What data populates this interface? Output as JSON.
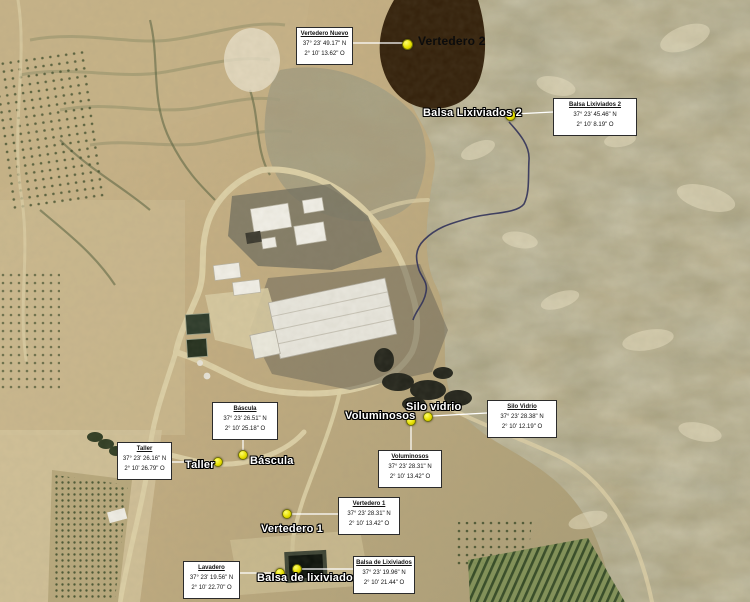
{
  "map": {
    "kind": "annotated-satellite-map",
    "subject": "waste treatment facility and landfill site"
  },
  "colors": {
    "terrain_tan": "#c3ad81",
    "badlands_olive": "#a89c76",
    "marker_yellow": "#e8e000",
    "marker_border": "#6f6f05",
    "vertedero2_fill": "#33200a",
    "callout_bg": "#ffffff",
    "callout_border": "#2b2b2b",
    "label_white": "#ffffff",
    "label_dark": "#0c0c0c",
    "leader_line": "#ffffff",
    "stream_line": "#2b2c58",
    "orchard_green": "#2f4722",
    "pond_dark": "#0c120b"
  },
  "labels": [
    {
      "text": "Vertedero 2"
    },
    {
      "text": "Balsa Lixiviados 2"
    },
    {
      "text": "Voluminosos"
    },
    {
      "text": "Silo vidrio"
    },
    {
      "text": "Taller"
    },
    {
      "text": "Báscula"
    },
    {
      "text": "Vertedero 1"
    },
    {
      "text": "Balsa de lixiviados"
    }
  ],
  "callouts": [
    {
      "title": "Vertedero Nuevo",
      "lat": "37° 23' 49.17\" N",
      "lon": "2° 10' 13.62\" O"
    },
    {
      "title": "Balsa Lixiviados 2",
      "lat": "37° 23' 45.46\" N",
      "lon": "2° 10' 8.19\" O"
    },
    {
      "title": "Báscula",
      "lat": "37° 23' 26.51\" N",
      "lon": "2° 10' 25.18\" O"
    },
    {
      "title": "Taller",
      "lat": "37° 23' 26.16\" N",
      "lon": "2° 10' 26.79\" O"
    },
    {
      "title": "Silo Vidrio",
      "lat": "37° 23' 28.38\" N",
      "lon": "2° 10' 12.19\" O"
    },
    {
      "title": "Voluminosos",
      "lat": "37° 23' 28.31\" N",
      "lon": "2° 10' 13.42\" O"
    },
    {
      "title": "Vertedero 1",
      "lat": "37° 23' 28.31\" N",
      "lon": "2° 10' 13.42\" O"
    },
    {
      "title": "Lavadero",
      "lat": "37° 23' 19.56\" N",
      "lon": "2° 10' 22.70\" O"
    },
    {
      "title": "Balsa de Lixiviados",
      "lat": "37° 23' 19.96\" N",
      "lon": "2° 10' 21.44\" O"
    }
  ]
}
